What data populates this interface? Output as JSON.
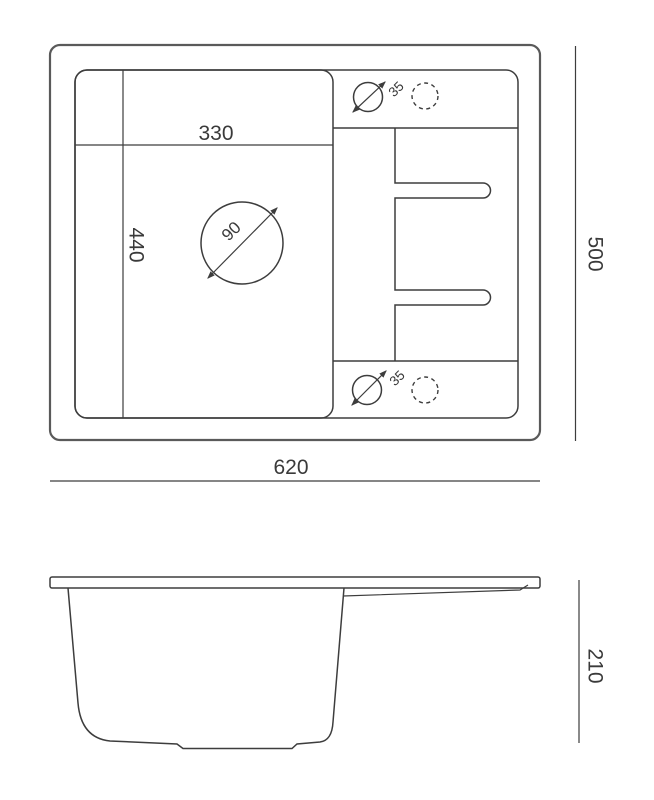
{
  "colors": {
    "background": "#ffffff",
    "line": "#3d3d3d",
    "outer_line": "#5a5a5a",
    "text": "#3a3a3a"
  },
  "top_view": {
    "labels": {
      "bowl_width": "330",
      "bowl_depth": "440",
      "drain_diameter": "90",
      "tap_hole_diameter_top": "35",
      "tap_hole_diameter_bottom": "35",
      "overall_width": "620",
      "overall_depth": "500"
    }
  },
  "side_view": {
    "labels": {
      "overall_height": "210"
    }
  }
}
